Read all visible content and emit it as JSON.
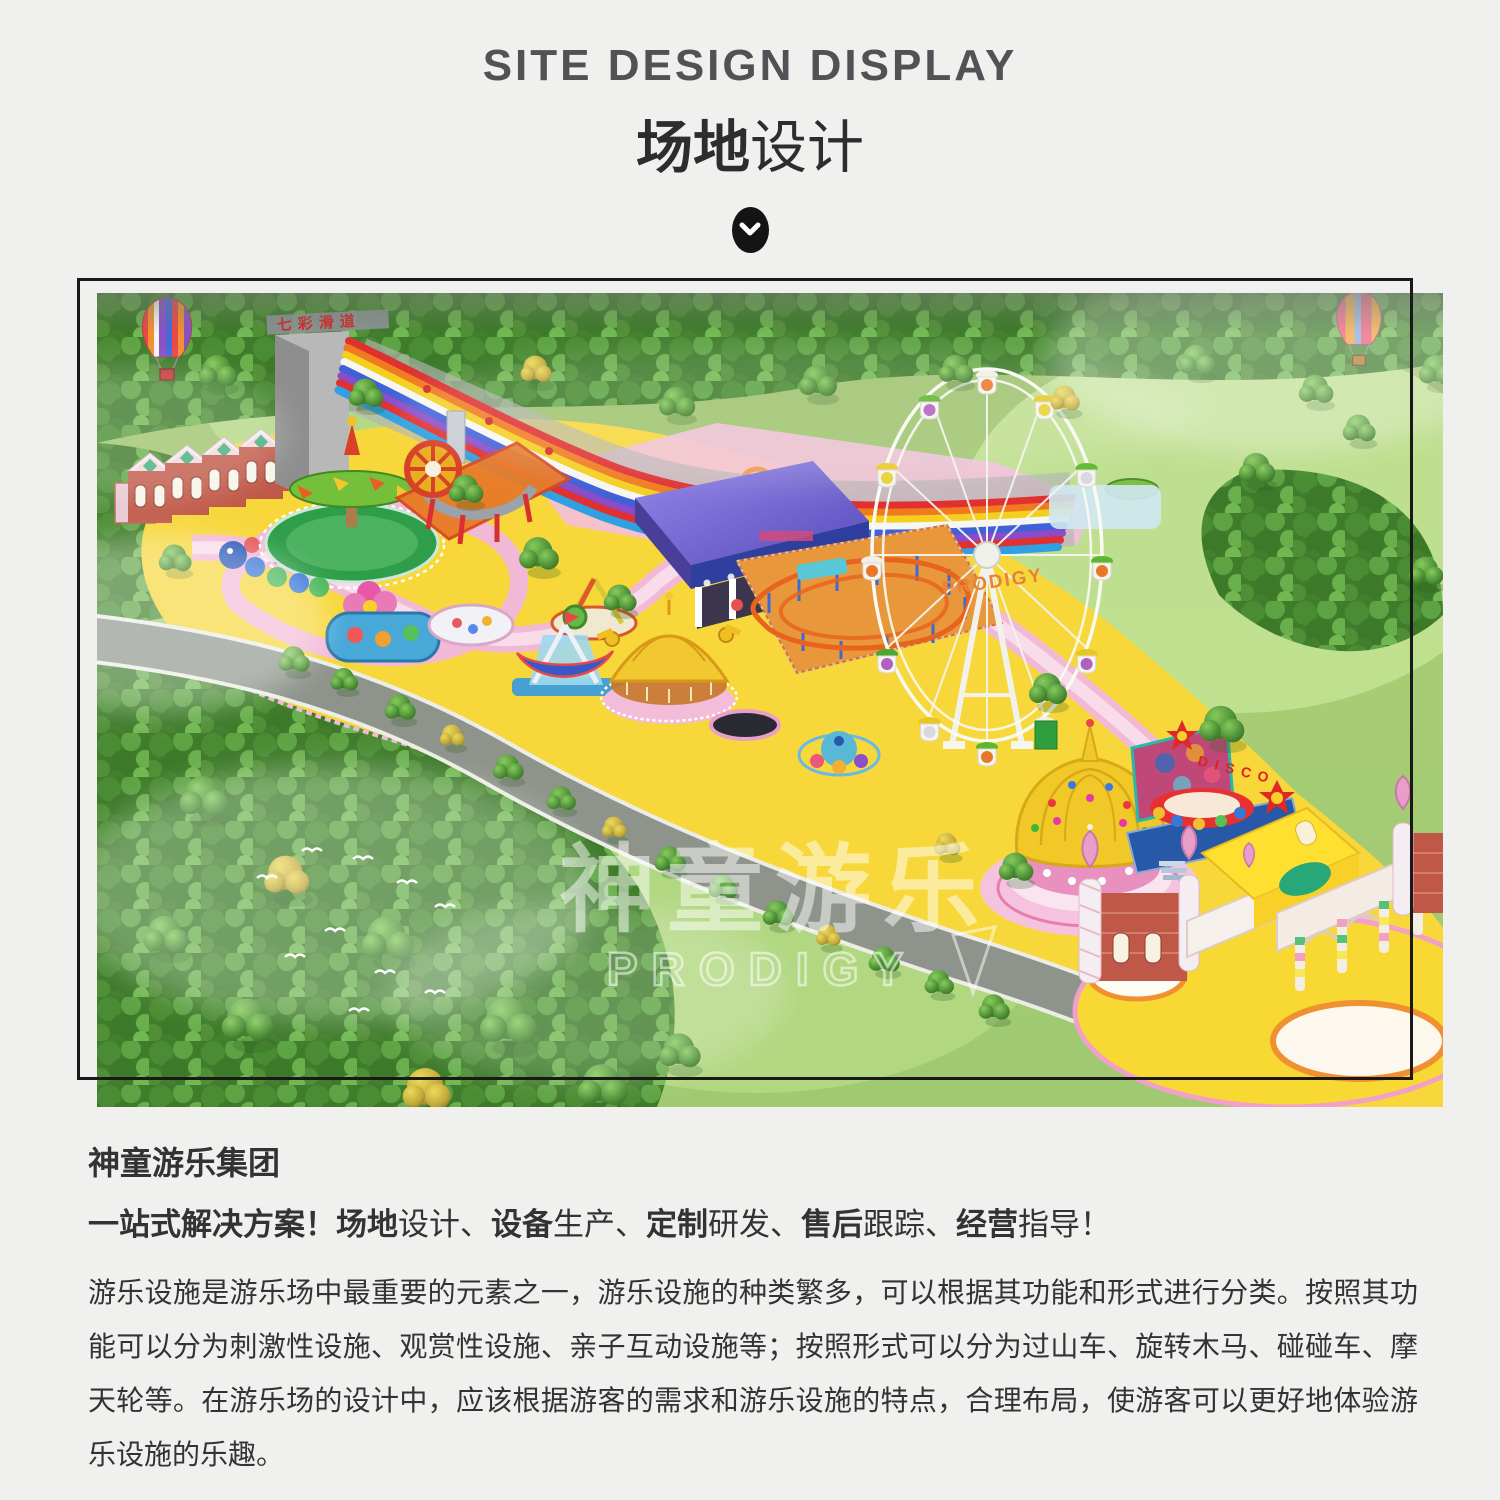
{
  "header": {
    "title_en": "SITE DESIGN DISPLAY",
    "title_zh_bold": "场地",
    "title_zh_rest": "设计"
  },
  "render": {
    "watermark_cn": "神童游乐",
    "watermark_en": "PRODIGY",
    "ferris_wheel_text": "PRODIGY",
    "slide_sign_text": "七彩滑道",
    "disco_sign_text": "DISCO"
  },
  "content": {
    "heading": "神童游乐集团",
    "tagline_segments": [
      {
        "t": "一站式解决方案！",
        "b": 1
      },
      {
        "t": "场地",
        "b": 1
      },
      {
        "t": "设计、",
        "b": 0
      },
      {
        "t": "设备",
        "b": 1
      },
      {
        "t": "生产、",
        "b": 0
      },
      {
        "t": "定制",
        "b": 1
      },
      {
        "t": "研发、",
        "b": 0
      },
      {
        "t": "售后",
        "b": 1
      },
      {
        "t": "跟踪、",
        "b": 0
      },
      {
        "t": "经营",
        "b": 1
      },
      {
        "t": "指导！",
        "b": 0
      }
    ],
    "paragraph": "游乐设施是游乐场中最重要的元素之一，游乐设施的种类繁多，可以根据其功能和形式进行分类。按照其功能可以分为刺激性设施、观赏性设施、亲子互动设施等；按照形式可以分为过山车、旋转木马、碰碰车、摩天轮等。在游乐场的设计中，应该根据游客的需求和游乐设施的特点，合理布局，使游客可以更好地体验游乐设施的乐趣。"
  }
}
